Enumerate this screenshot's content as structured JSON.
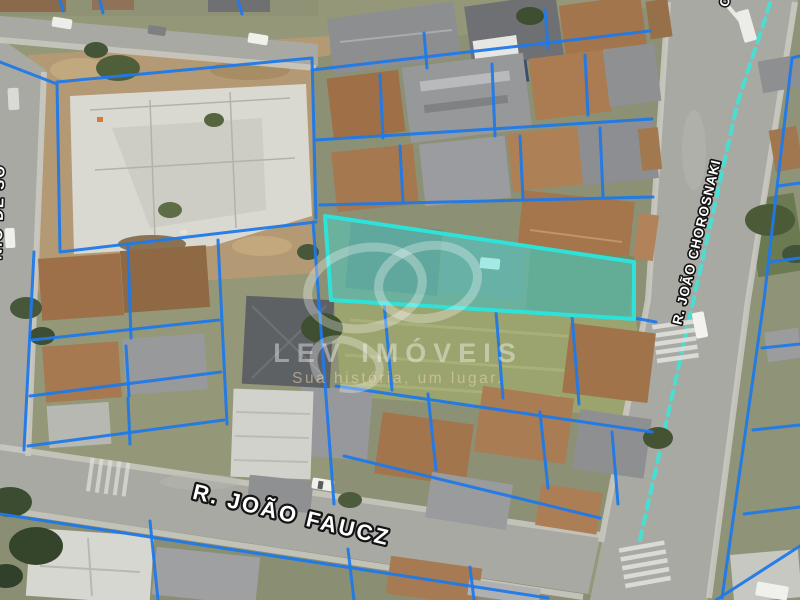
{
  "watermark": {
    "brand": "LEV IMÓVEIS",
    "tagline": "Sua história, um lugar.",
    "logo": "lev-rings-logo"
  },
  "streets": {
    "bottom": "R. JOÃO FAUCZ",
    "right": "R. JOÃO CHOROSNAKI",
    "left_partial": "NIO DE SO",
    "top_partial": "O"
  },
  "overlay": {
    "parcel_line_color": "#2079e8",
    "highlight_stroke": "#2ee2d9",
    "highlight_fill": "rgba(64,224,216,0.42)",
    "road_centerline_color": "#45e0d5"
  }
}
